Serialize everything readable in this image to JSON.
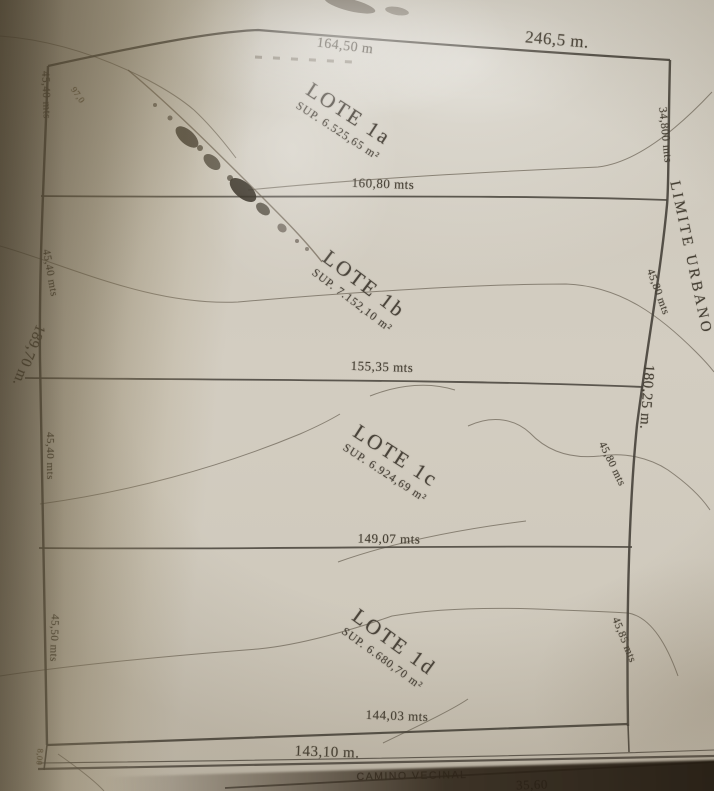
{
  "plan": {
    "top_edge": {
      "segment": "164,50 m",
      "total": "246,5 m."
    },
    "left_edge": {
      "total": "189,70 m.",
      "corner": "97,0"
    },
    "right_edge": {
      "boundary": "LIMITE URBANO",
      "total": "180,25 m."
    },
    "bottom_edge": {
      "frontage": "143,10 m.",
      "partial": "35,60"
    },
    "road": {
      "name": "CAMINO VECINAL",
      "width": "8,00"
    },
    "lots": [
      {
        "name": "LOTE 1a",
        "area": "SUP. 6.525,65 m²",
        "bottom": "160,80 mts",
        "left": "45,40 mts",
        "right": "34,800 mts"
      },
      {
        "name": "LOTE 1b",
        "area": "SUP. 7.152,10 m²",
        "bottom": "155,35 mts",
        "left": "45,40 mts",
        "right": "45,80 mts"
      },
      {
        "name": "LOTE 1c",
        "area": "SUP. 6.924,69 m²",
        "bottom": "149,07 mts",
        "left": "45,40 mts",
        "right": "45,80 mts"
      },
      {
        "name": "LOTE 1d",
        "area": "SUP. 6.680,70 m²",
        "bottom": "144,03 mts",
        "left": "45,50 mts",
        "right": "45,85 mts"
      }
    ],
    "colors": {
      "paper": "#cfc9bc",
      "ink": "#3f3a31",
      "shadow": "#5a4c34"
    }
  }
}
